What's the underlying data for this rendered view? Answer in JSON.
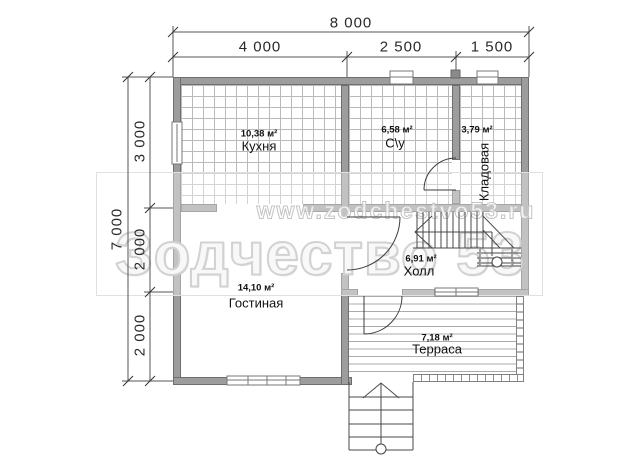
{
  "dimensions": {
    "top": {
      "overall": "8 000",
      "segments": [
        "4 000",
        "2 500",
        "1 500"
      ]
    },
    "left": {
      "overall": "7 000",
      "segments": [
        "3 000",
        "2 000",
        "2 000"
      ]
    }
  },
  "rooms": {
    "kitchen": {
      "area": "10,38 м²",
      "name": "Кухня"
    },
    "bathroom": {
      "area": "6,58 м²",
      "name": "С\\у"
    },
    "storage": {
      "area": "3,79 м²",
      "name": "Кладовая"
    },
    "hall": {
      "area": "6,91 м²",
      "name": "Холл"
    },
    "living": {
      "area": "14,10 м²",
      "name": "Гостиная"
    },
    "terrace": {
      "area": "7,18 м²",
      "name": "Терраса"
    }
  },
  "watermark": {
    "url": "www.zodchestvo53.ru",
    "brand": "Зодчество 53"
  },
  "colors": {
    "wall": "#9d9d9d",
    "line": "#3c3c3c",
    "dim_line": "#555555",
    "hatch": "#b9b9b9",
    "watermark": "#d2d2d2"
  }
}
